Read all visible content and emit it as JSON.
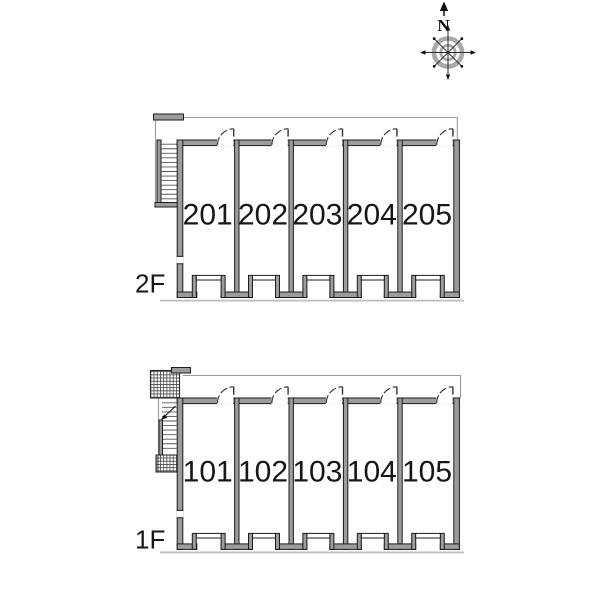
{
  "compass": {
    "north_label": "N"
  },
  "floors": [
    {
      "label": "2F",
      "rooms": [
        "201",
        "202",
        "203",
        "204",
        "205"
      ]
    },
    {
      "label": "1F",
      "rooms": [
        "101",
        "102",
        "103",
        "104",
        "105"
      ]
    }
  ],
  "colors": {
    "background": "#ffffff",
    "wall_outline": "#1c1c1c",
    "wall_fill": "#9c9c9c",
    "thin_line": "#9a9a9a",
    "ground_shadow": "#bdbdbd",
    "compass_ring": "#a9a9a9",
    "text": "#161616"
  }
}
